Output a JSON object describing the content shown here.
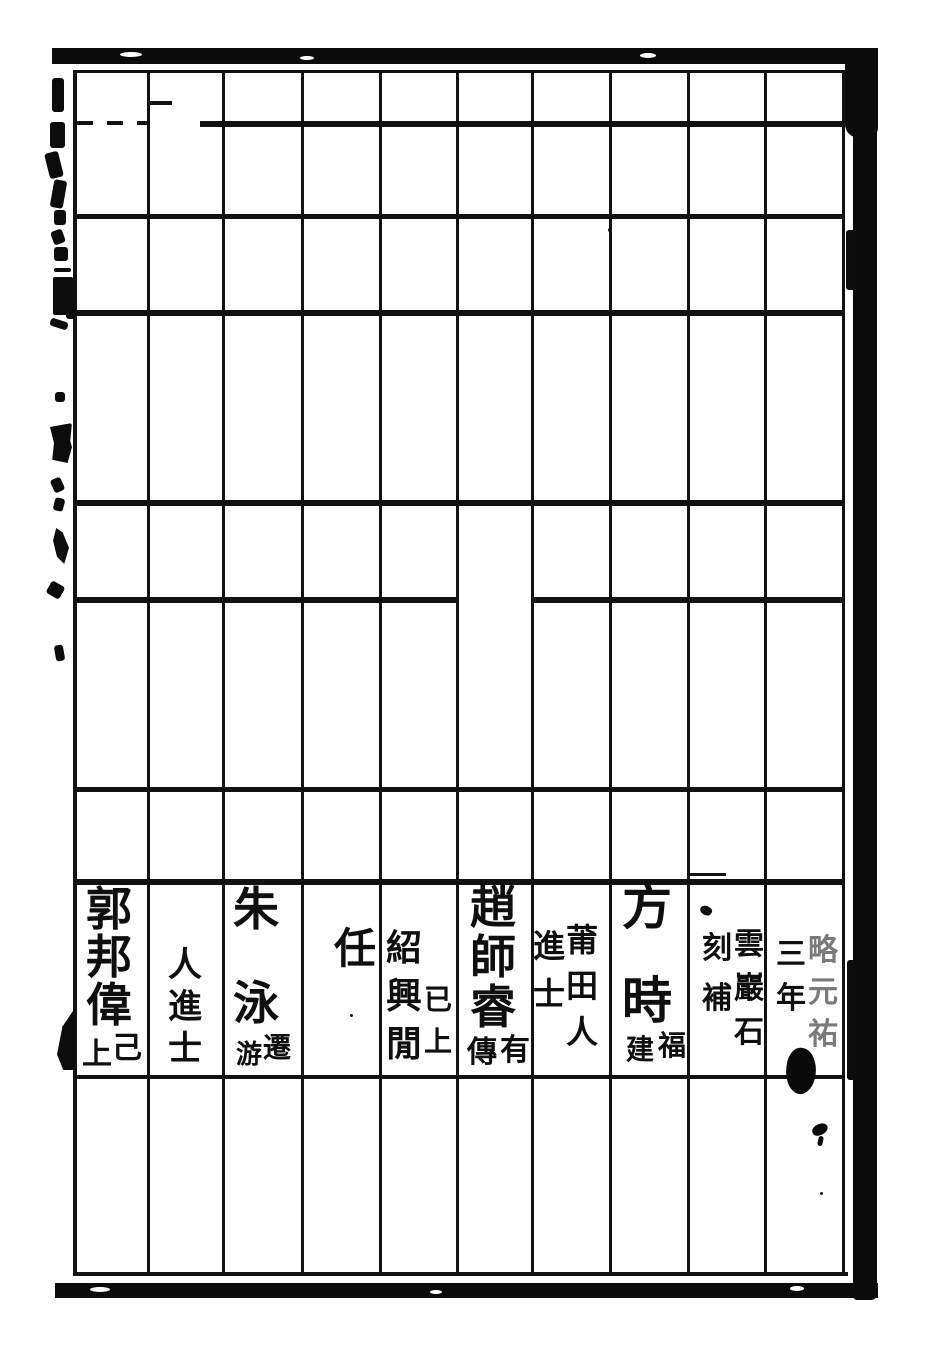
{
  "page": {
    "kind_label": "scanned woodblock-printed table page",
    "paper_color": "#ffffff",
    "ink_color": "#0f0f0f"
  },
  "columns": [
    {
      "main": "郭邦偉",
      "ann_left": "上",
      "ann_right": "己"
    },
    {
      "note": "人進士"
    },
    {
      "main": "朱泳",
      "ann_left": "游",
      "ann_right": "遷"
    },
    {
      "note": "任"
    },
    {
      "main": "紹興閒",
      "ann_right": "已上"
    },
    {
      "main": "趙師睿",
      "ann_left": "傳",
      "ann_right": "有"
    },
    {
      "note_right": "莆田人",
      "note_left": "進士"
    },
    {
      "main": "方時",
      "ann_left": "建",
      "ann_right": "福"
    },
    {
      "note_right": "雲巖石",
      "note_left": "刻補"
    },
    {
      "note_right": "略元祐",
      "note_left": "三年"
    }
  ]
}
